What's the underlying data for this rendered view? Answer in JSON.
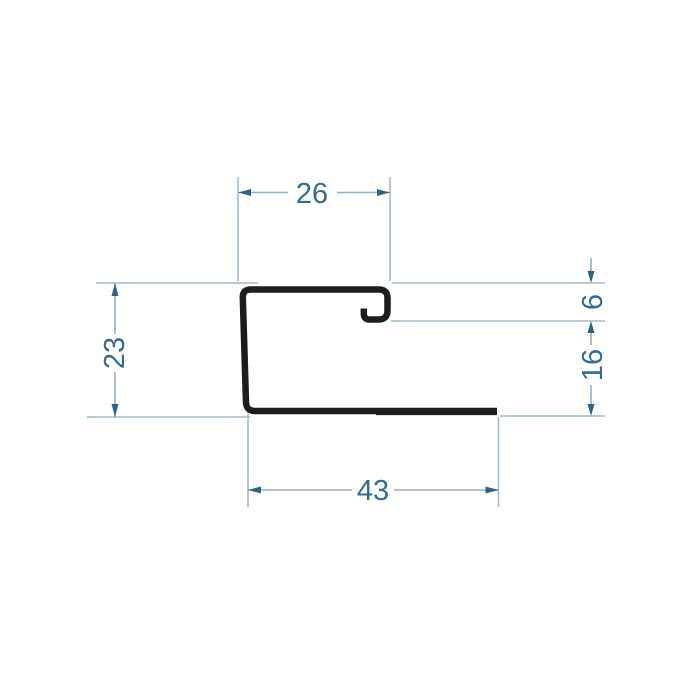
{
  "drawing": {
    "title": "profile-cross-section",
    "colors": {
      "background": "#ffffff",
      "profile": "#1d1d1b",
      "extension_line": "#a3bac9",
      "dimension_line": "#8fafc3",
      "arrow": "#2e6384",
      "text": "#336a90"
    },
    "dimensions": {
      "top_width": {
        "value": "26"
      },
      "left_height": {
        "value": "23"
      },
      "right_upper": {
        "value": "6"
      },
      "right_lower": {
        "value": "16"
      },
      "bottom_width": {
        "value": "43"
      }
    }
  }
}
